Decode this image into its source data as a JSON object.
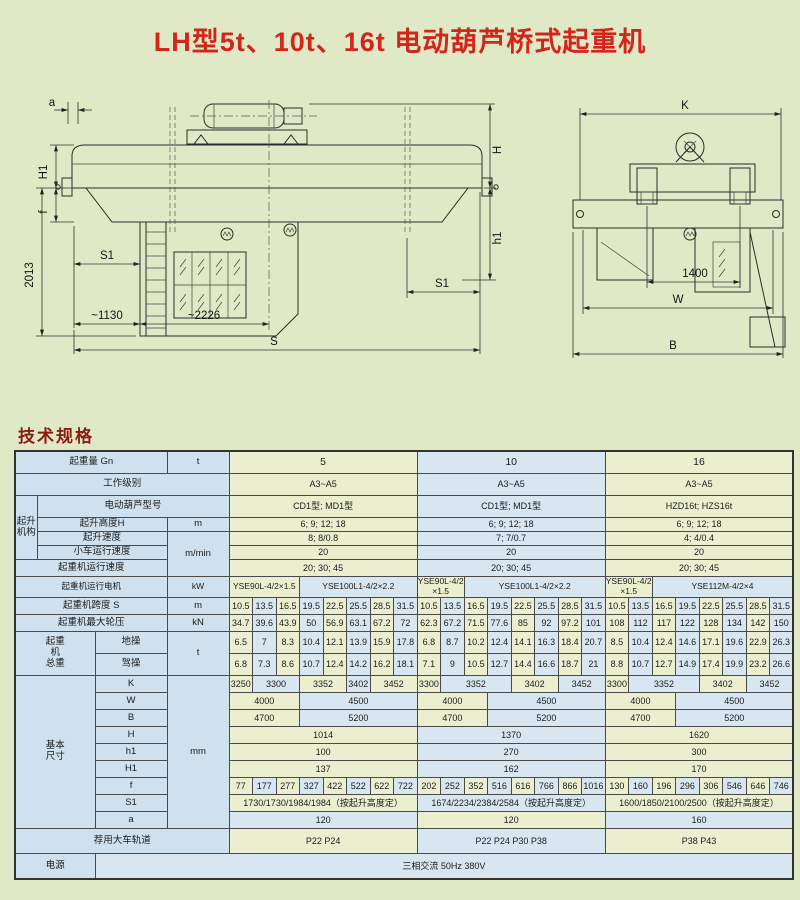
{
  "title": "LH型5t、10t、16t 电动葫芦桥式起重机",
  "section_heading": "技术规格",
  "drawings": {
    "front": {
      "a": "a",
      "h1_left": "H1",
      "f": "f",
      "d2013": "2013",
      "s1_left": "S1",
      "d1130": "~1130",
      "d2226": "~2226",
      "s": "S",
      "s1_right": "S1",
      "h_right": "H",
      "h1_right": "h1"
    },
    "side": {
      "k": "K",
      "d1400": "1400",
      "w": "W",
      "b": "B"
    }
  },
  "table": {
    "capacity": {
      "label": "起重量 Gn",
      "unit": "t",
      "values": [
        "5",
        "10",
        "16"
      ]
    },
    "duty": {
      "label": "工作级别",
      "values": [
        "A3~A5",
        "A3~A5",
        "A3~A5"
      ]
    },
    "hoist_group": "起升\n机构",
    "model": {
      "label": "电动葫芦型号",
      "values": [
        "CD1型; MD1型",
        "CD1型; MD1型",
        "HZD16t; HZS16t"
      ]
    },
    "height": {
      "label": "起升高度H",
      "unit": "m",
      "values": [
        "6; 9; 12; 18",
        "6; 9; 12; 18",
        "6; 9; 12; 18"
      ]
    },
    "lift_speed": {
      "label": "起升速度",
      "unit": "m/min",
      "values": [
        "8; 8/0.8",
        "7; 7/0.7",
        "4; 4/0.4"
      ]
    },
    "trolley_speed": {
      "label": "小车运行速度",
      "values": [
        "20",
        "20",
        "20"
      ]
    },
    "crane_speed": {
      "label": "起重机运行速度",
      "values": [
        "20; 30; 45",
        "20; 30; 45",
        "20; 30; 45"
      ]
    },
    "motor": {
      "label": "起重机运行电机",
      "unit": "kW",
      "cells": [
        [
          {
            "v": "YSE90L-4/2×1.5",
            "s": 3
          },
          {
            "v": "YSE100L1-4/2×2.2",
            "s": 5
          }
        ],
        [
          {
            "v": "YSE90L-4/2\n×1.5",
            "s": 2
          },
          {
            "v": "YSE100L1-4/2×2.2",
            "s": 6
          }
        ],
        [
          {
            "v": "YSE90L-4/2\n×1.5",
            "s": 2
          },
          {
            "v": "YSE112M-4/2×4",
            "s": 6
          }
        ]
      ]
    },
    "span": {
      "label": "起重机跨度 S",
      "unit": "m",
      "cells": [
        [
          "10.5",
          "13.5",
          "16.5",
          "19.5",
          "22.5",
          "25.5",
          "28.5",
          "31.5"
        ],
        [
          "10.5",
          "13.5",
          "16.5",
          "19.5",
          "22.5",
          "25.5",
          "28.5",
          "31.5"
        ],
        [
          "10.5",
          "13.5",
          "16.5",
          "19.5",
          "22.5",
          "25.5",
          "28.5",
          "31.5"
        ]
      ]
    },
    "wheel_load": {
      "label": "起重机最大轮压",
      "unit": "kN",
      "cells": [
        [
          "34.7",
          "39.6",
          "43.9",
          "50",
          "56.9",
          "63.1",
          "67.2",
          "72"
        ],
        [
          "62.3",
          "67.2",
          "71.5",
          "77.6",
          "85",
          "92",
          "97.2",
          "101"
        ],
        [
          "108",
          "112",
          "117",
          "122",
          "128",
          "134",
          "142",
          "150"
        ]
      ]
    },
    "weight_group": "起重\n机\n总重",
    "weight_unit": "t",
    "ground_op": {
      "label": "地操",
      "cells": [
        [
          "6.5",
          "7",
          "8.3",
          "10.4",
          "12.1",
          "13.9",
          "15.9",
          "17.8"
        ],
        [
          "6.8",
          "8.7",
          "10.2",
          "12.4",
          "14.1",
          "16.3",
          "18.4",
          "20.7"
        ],
        [
          "8.5",
          "10.4",
          "12.4",
          "14.6",
          "17.1",
          "19.6",
          "22.9",
          "26.3"
        ]
      ]
    },
    "cab_op": {
      "label": "驾操",
      "cells": [
        [
          "6.8",
          "7.3",
          "8.6",
          "10.7",
          "12.4",
          "14.2",
          "16.2",
          "18.1"
        ],
        [
          "7.1",
          "9",
          "10.5",
          "12.7",
          "14.4",
          "16.6",
          "18.7",
          "21"
        ],
        [
          "8.8",
          "10.7",
          "12.7",
          "14.9",
          "17.4",
          "19.9",
          "23.2",
          "26.6"
        ]
      ]
    },
    "dims_group": "基本\n尺寸",
    "dims_unit": "mm",
    "K": {
      "label": "K",
      "cells": [
        [
          {
            "v": "3250",
            "s": 1
          },
          {
            "v": "3300",
            "s": 2
          },
          {
            "v": "3352",
            "s": 2
          },
          {
            "v": "3402",
            "s": 1
          },
          {
            "v": "3452",
            "s": 2
          }
        ],
        [
          {
            "v": "3300",
            "s": 1
          },
          {
            "v": "3352",
            "s": 3
          },
          {
            "v": "3402",
            "s": 2
          },
          {
            "v": "3452",
            "s": 2
          }
        ],
        [
          {
            "v": "3300",
            "s": 1
          },
          {
            "v": "3352",
            "s": 3
          },
          {
            "v": "3402",
            "s": 2
          },
          {
            "v": "3452",
            "s": 2
          }
        ]
      ]
    },
    "W": {
      "label": "W",
      "cells": [
        [
          {
            "v": "4000",
            "s": 3
          },
          {
            "v": "4500",
            "s": 5
          }
        ],
        [
          {
            "v": "4000",
            "s": 3
          },
          {
            "v": "4500",
            "s": 5
          }
        ],
        [
          {
            "v": "4000",
            "s": 3
          },
          {
            "v": "4500",
            "s": 5
          }
        ]
      ]
    },
    "B": {
      "label": "B",
      "cells": [
        [
          {
            "v": "4700",
            "s": 3
          },
          {
            "v": "5200",
            "s": 5
          }
        ],
        [
          {
            "v": "4700",
            "s": 3
          },
          {
            "v": "5200",
            "s": 5
          }
        ],
        [
          {
            "v": "4700",
            "s": 3
          },
          {
            "v": "5200",
            "s": 5
          }
        ]
      ]
    },
    "H": {
      "label": "H",
      "values": [
        "1014",
        "1370",
        "1620"
      ]
    },
    "h1": {
      "label": "h1",
      "values": [
        "100",
        "270",
        "300"
      ]
    },
    "H1": {
      "label": "H1",
      "values": [
        "137",
        "162",
        "170"
      ]
    },
    "f": {
      "label": "f",
      "cells": [
        [
          "77",
          "177",
          "277",
          "327",
          "422",
          "522",
          "622",
          "722"
        ],
        [
          "202",
          "252",
          "352",
          "516",
          "616",
          "766",
          "866",
          "1016"
        ],
        [
          "130",
          "160",
          "196",
          "296",
          "306",
          "546",
          "646",
          "746"
        ]
      ]
    },
    "S1": {
      "label": "S1",
      "values": [
        "1730/1730/1984/1984（按起升高度定）",
        "1674/2234/2384/2584（按起升高度定）",
        "1600/1850/2100/2500（按起升高度定）"
      ]
    },
    "a": {
      "label": "a",
      "values": [
        "120",
        "120",
        "160"
      ]
    },
    "rail": {
      "label": "荐用大车轨道",
      "values": [
        "P22  P24",
        "P22  P24  P30  P38",
        "P38  P43"
      ]
    },
    "power": {
      "label": "电源",
      "value": "三相交流  50Hz  380V"
    }
  }
}
